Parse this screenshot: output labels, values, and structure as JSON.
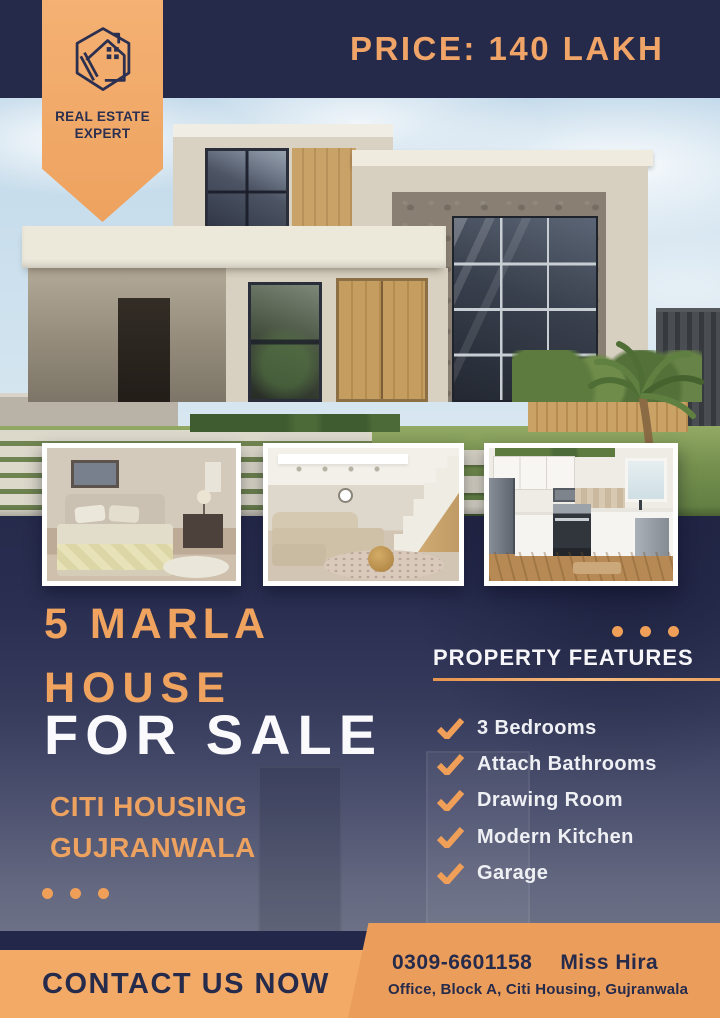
{
  "badge": {
    "title_line1": "REAL ESTATE",
    "title_line2": "EXPERT"
  },
  "topbar": {
    "price_label": "PRICE: 140 LAKH"
  },
  "headline": {
    "size": "5 MARLA",
    "house": "HOUSE",
    "for_sale": "FOR SALE"
  },
  "location": {
    "line1": "CITI HOUSING",
    "line2": "GUJRANWALA"
  },
  "features": {
    "title": "PROPERTY FEATURES",
    "items": [
      "3 Bedrooms",
      "Attach Bathrooms",
      "Drawing Room",
      "Modern Kitchen",
      "Garage"
    ]
  },
  "contact": {
    "cta": "CONTACT US NOW",
    "phone": "0309-6601158",
    "agent": "Miss Hira",
    "address": "Office, Block A, Citi Housing, Gujranwala"
  },
  "colors": {
    "navy": "#272b4d",
    "accent_orange": "#f0a160",
    "band_orange": "#f3aa67",
    "panel_orange": "#eb9d5b",
    "white": "#ffffff"
  },
  "icons": {
    "logo": "hexagon-house-icon",
    "feature_bullet": "check-icon",
    "decor": "three-dots"
  },
  "photos": {
    "main": "modern-house-exterior",
    "thumb1": "bedroom",
    "thumb2": "living-room-with-staircase",
    "thumb3": "kitchen"
  }
}
